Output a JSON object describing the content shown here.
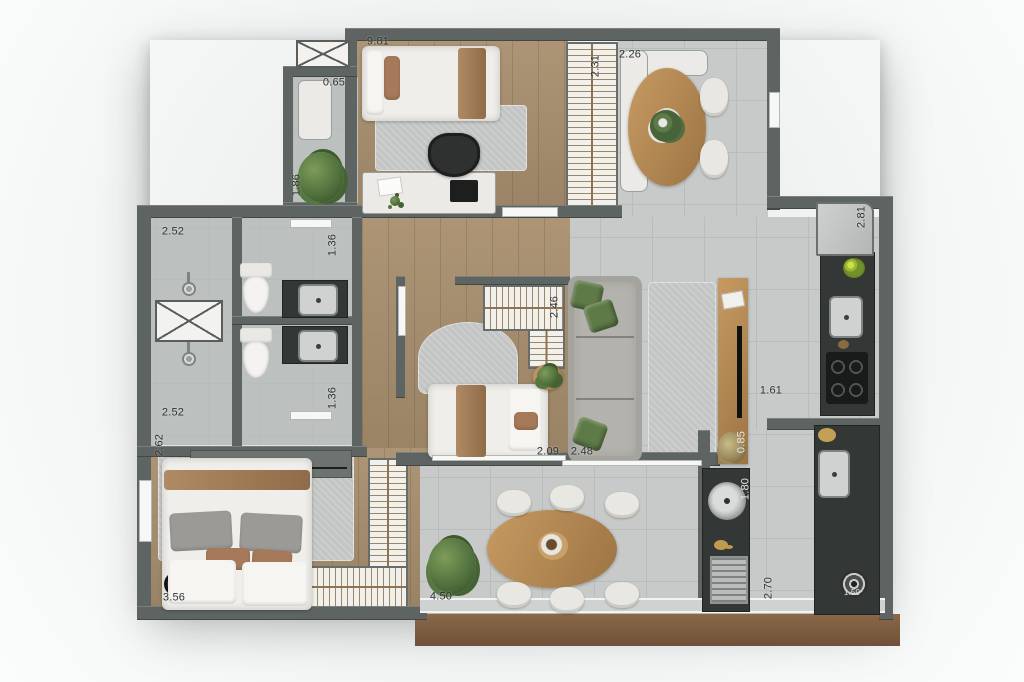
{
  "plan": {
    "type": "apartment-floor-plan",
    "dims": {
      "bedroom_top_width": "9.81",
      "balcony_top_width": "0.65",
      "balcony_top_depth": "1.86",
      "hall_closet_depth": "2.31",
      "dining_nook_width": "2.26",
      "kitchen_counter_length": "2.81",
      "bath_top_width": "2.52",
      "bath_top_depth": "1.36",
      "bedroom_mid_closet": "2.46",
      "bath_bottom_depth": "1.36",
      "bath_bottom_width": "2.52",
      "bedroom_bottom_depth": "2.62",
      "bedroom_bottom_width": "3.56",
      "bedroom_mid_width": "2.09",
      "living_width": "2.48",
      "kitchen_passage": "1.61",
      "console_width": "0.85",
      "laundry_counter": "1.80",
      "terrace_width": "4.50",
      "service_depth": "2.70",
      "washer_size": "1.50"
    },
    "colors": {
      "wall": "#5e6462",
      "floor_tile": "#c7cac9",
      "floor_wood": "#a78e6d",
      "counter_dark": "#333736",
      "closet_fill": "#f2f0ea",
      "hatch": "#8d7352",
      "plant_green": "#4e6e3c",
      "table_wood": "#b5854f",
      "deck_brown": "#7b5a40"
    }
  }
}
